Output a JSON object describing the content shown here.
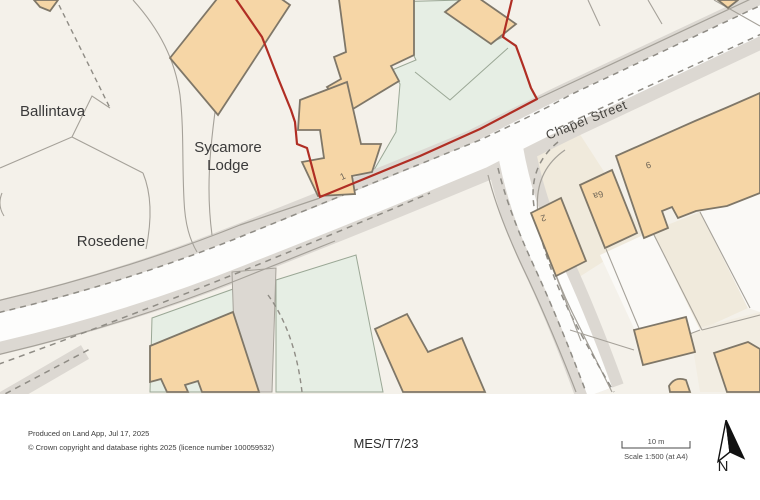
{
  "map": {
    "labels": {
      "ballintava": "Ballintava",
      "sycamore_lodge_line1": "Sycamore",
      "sycamore_lodge_line2": "Lodge",
      "rosedene": "Rosedene",
      "chapel_street": "Chapel Street"
    },
    "plot_numbers": {
      "site": "1",
      "no2": "2",
      "no6a": "6a",
      "no9": "9"
    },
    "colors": {
      "background": "#F4F1EA",
      "site_boundary_red": "#B02E24",
      "building_fill": "#F6D6A6",
      "building_outline": "#7F7768",
      "road_fill": "#DCD8D2",
      "road_surface": "#FDFDFC",
      "green_space": "#E6EEE4",
      "parcel_line": "#A5A199"
    }
  },
  "footer": {
    "produced_line": "Produced on Land App, Jul 17, 2025",
    "copyright_line": "© Crown copyright and database rights 2025 (licence number 100059532)",
    "reference": "MES/T7/23",
    "scale_bar_label": "10 m",
    "scale_text": "Scale 1:500 (at A4)",
    "north_label": "N"
  }
}
